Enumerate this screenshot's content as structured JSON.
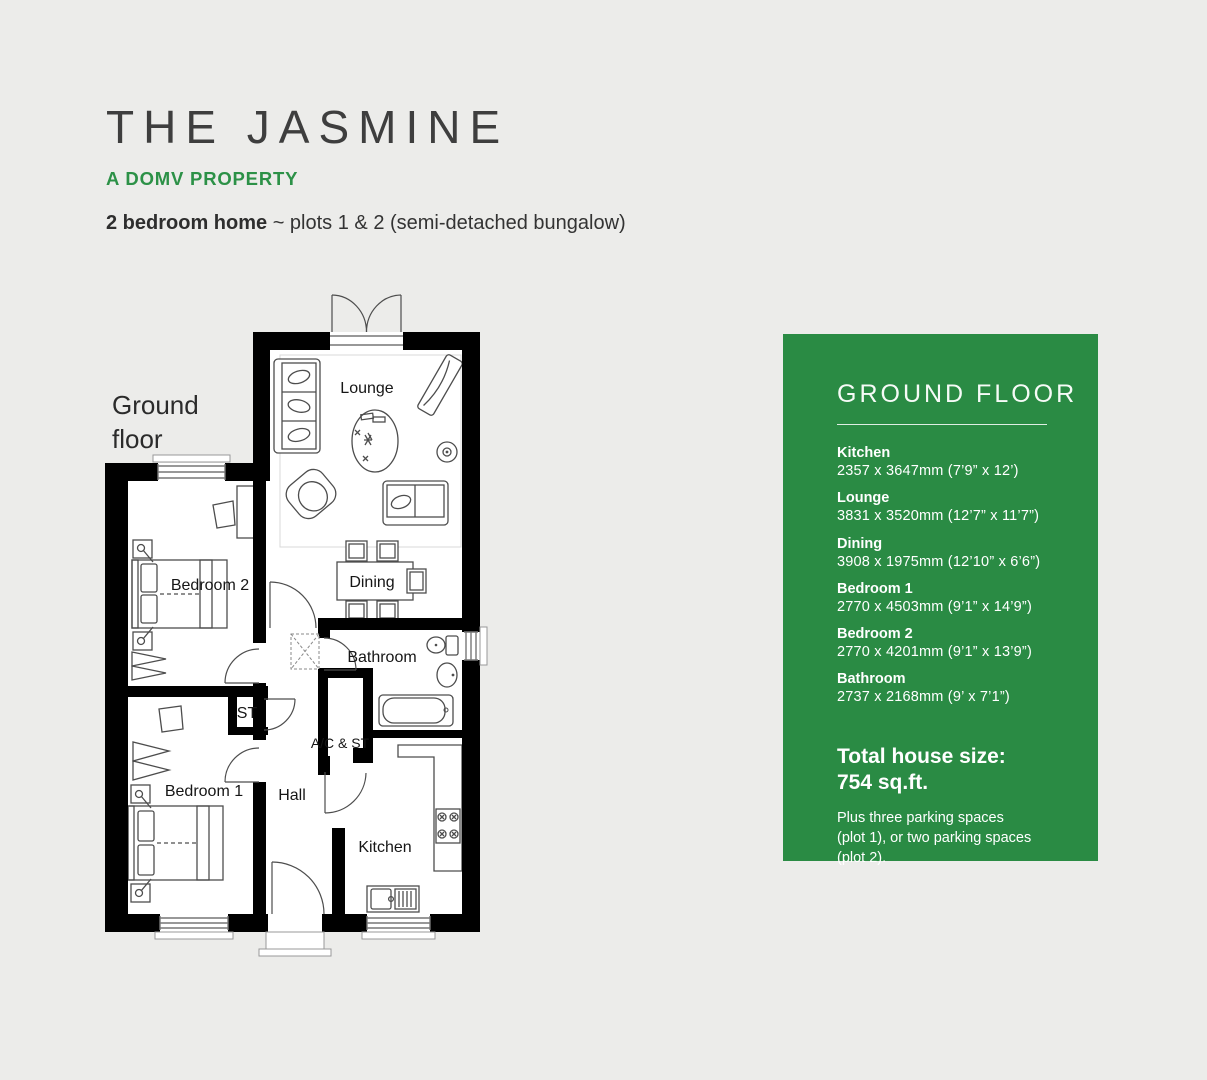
{
  "page": {
    "title": "THE JASMINE",
    "tagline": "A DOMV PROPERTY",
    "subtitle_bold": "2 bedroom home",
    "subtitle_rest": " ~ plots 1 & 2 (semi-detached bungalow)",
    "floor_label_line1": "Ground",
    "floor_label_line2": "floor"
  },
  "floorplan": {
    "rooms": [
      {
        "label": "Lounge"
      },
      {
        "label": "Dining"
      },
      {
        "label": "Bedroom 2"
      },
      {
        "label": "Bathroom"
      },
      {
        "label": "ST"
      },
      {
        "label": "A/C & ST"
      },
      {
        "label": "Bedroom 1"
      },
      {
        "label": "Hall"
      },
      {
        "label": "Kitchen"
      }
    ]
  },
  "panel": {
    "heading": "GROUND FLOOR",
    "rooms": [
      {
        "name": "Kitchen",
        "dims": "2357 x 3647mm (7’9” x 12’)"
      },
      {
        "name": "Lounge",
        "dims": "3831 x 3520mm (12’7” x 11’7”)"
      },
      {
        "name": "Dining",
        "dims": "3908 x 1975mm (12’10” x 6’6”)"
      },
      {
        "name": "Bedroom 1",
        "dims": "2770 x 4503mm (9’1” x 14’9”)"
      },
      {
        "name": "Bedroom 2",
        "dims": "2770 x 4201mm (9’1” x 13’9”)"
      },
      {
        "name": "Bathroom",
        "dims": "2737 x 2168mm (9’ x 7’1”)"
      }
    ],
    "total_label": "Total house size:",
    "total_value": "754 sq.ft.",
    "parking_lines": [
      "Plus three parking spaces",
      "(plot 1), or two parking spaces",
      "(plot 2)."
    ]
  },
  "colors": {
    "background": "#ececea",
    "panel_green": "#2a8b44",
    "accent_green": "#2c9147",
    "title_gray": "#3e3e3e",
    "wall_black": "#000000"
  }
}
